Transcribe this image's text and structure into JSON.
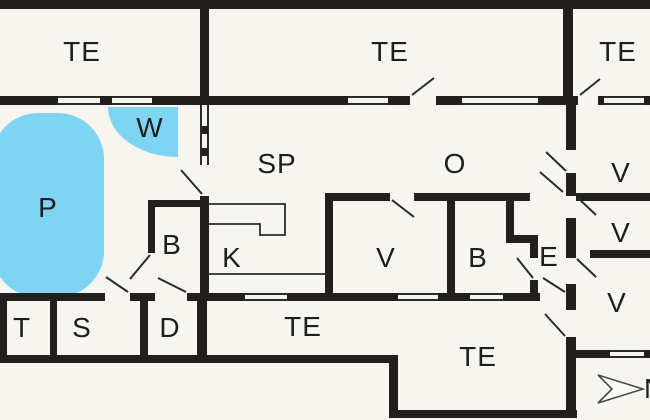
{
  "floorplan": {
    "labels": [
      {
        "id": "te-top-left",
        "text": "TE"
      },
      {
        "id": "te-top-center",
        "text": "TE"
      },
      {
        "id": "te-top-right",
        "text": "TE"
      },
      {
        "id": "w-spa",
        "text": "W"
      },
      {
        "id": "p-pool",
        "text": "P"
      },
      {
        "id": "sp-room",
        "text": "SP"
      },
      {
        "id": "o-room",
        "text": "O"
      },
      {
        "id": "v-right-1",
        "text": "V"
      },
      {
        "id": "v-right-2",
        "text": "V"
      },
      {
        "id": "v-right-3",
        "text": "V"
      },
      {
        "id": "b-pool-side",
        "text": "B"
      },
      {
        "id": "k-kitchen",
        "text": "K"
      },
      {
        "id": "v-middle",
        "text": "V"
      },
      {
        "id": "b-middle",
        "text": "B"
      },
      {
        "id": "e-entry",
        "text": "E"
      },
      {
        "id": "t-room",
        "text": "T"
      },
      {
        "id": "s-room",
        "text": "S"
      },
      {
        "id": "d-room",
        "text": "D"
      },
      {
        "id": "te-middle",
        "text": "TE"
      },
      {
        "id": "te-bottom",
        "text": "TE"
      }
    ],
    "compass": {
      "label": "N"
    },
    "colors": {
      "wall": "#221f1c",
      "water": "#7fd5f1",
      "floor": "#f7f5f0",
      "line": "#2b2b2b"
    }
  }
}
